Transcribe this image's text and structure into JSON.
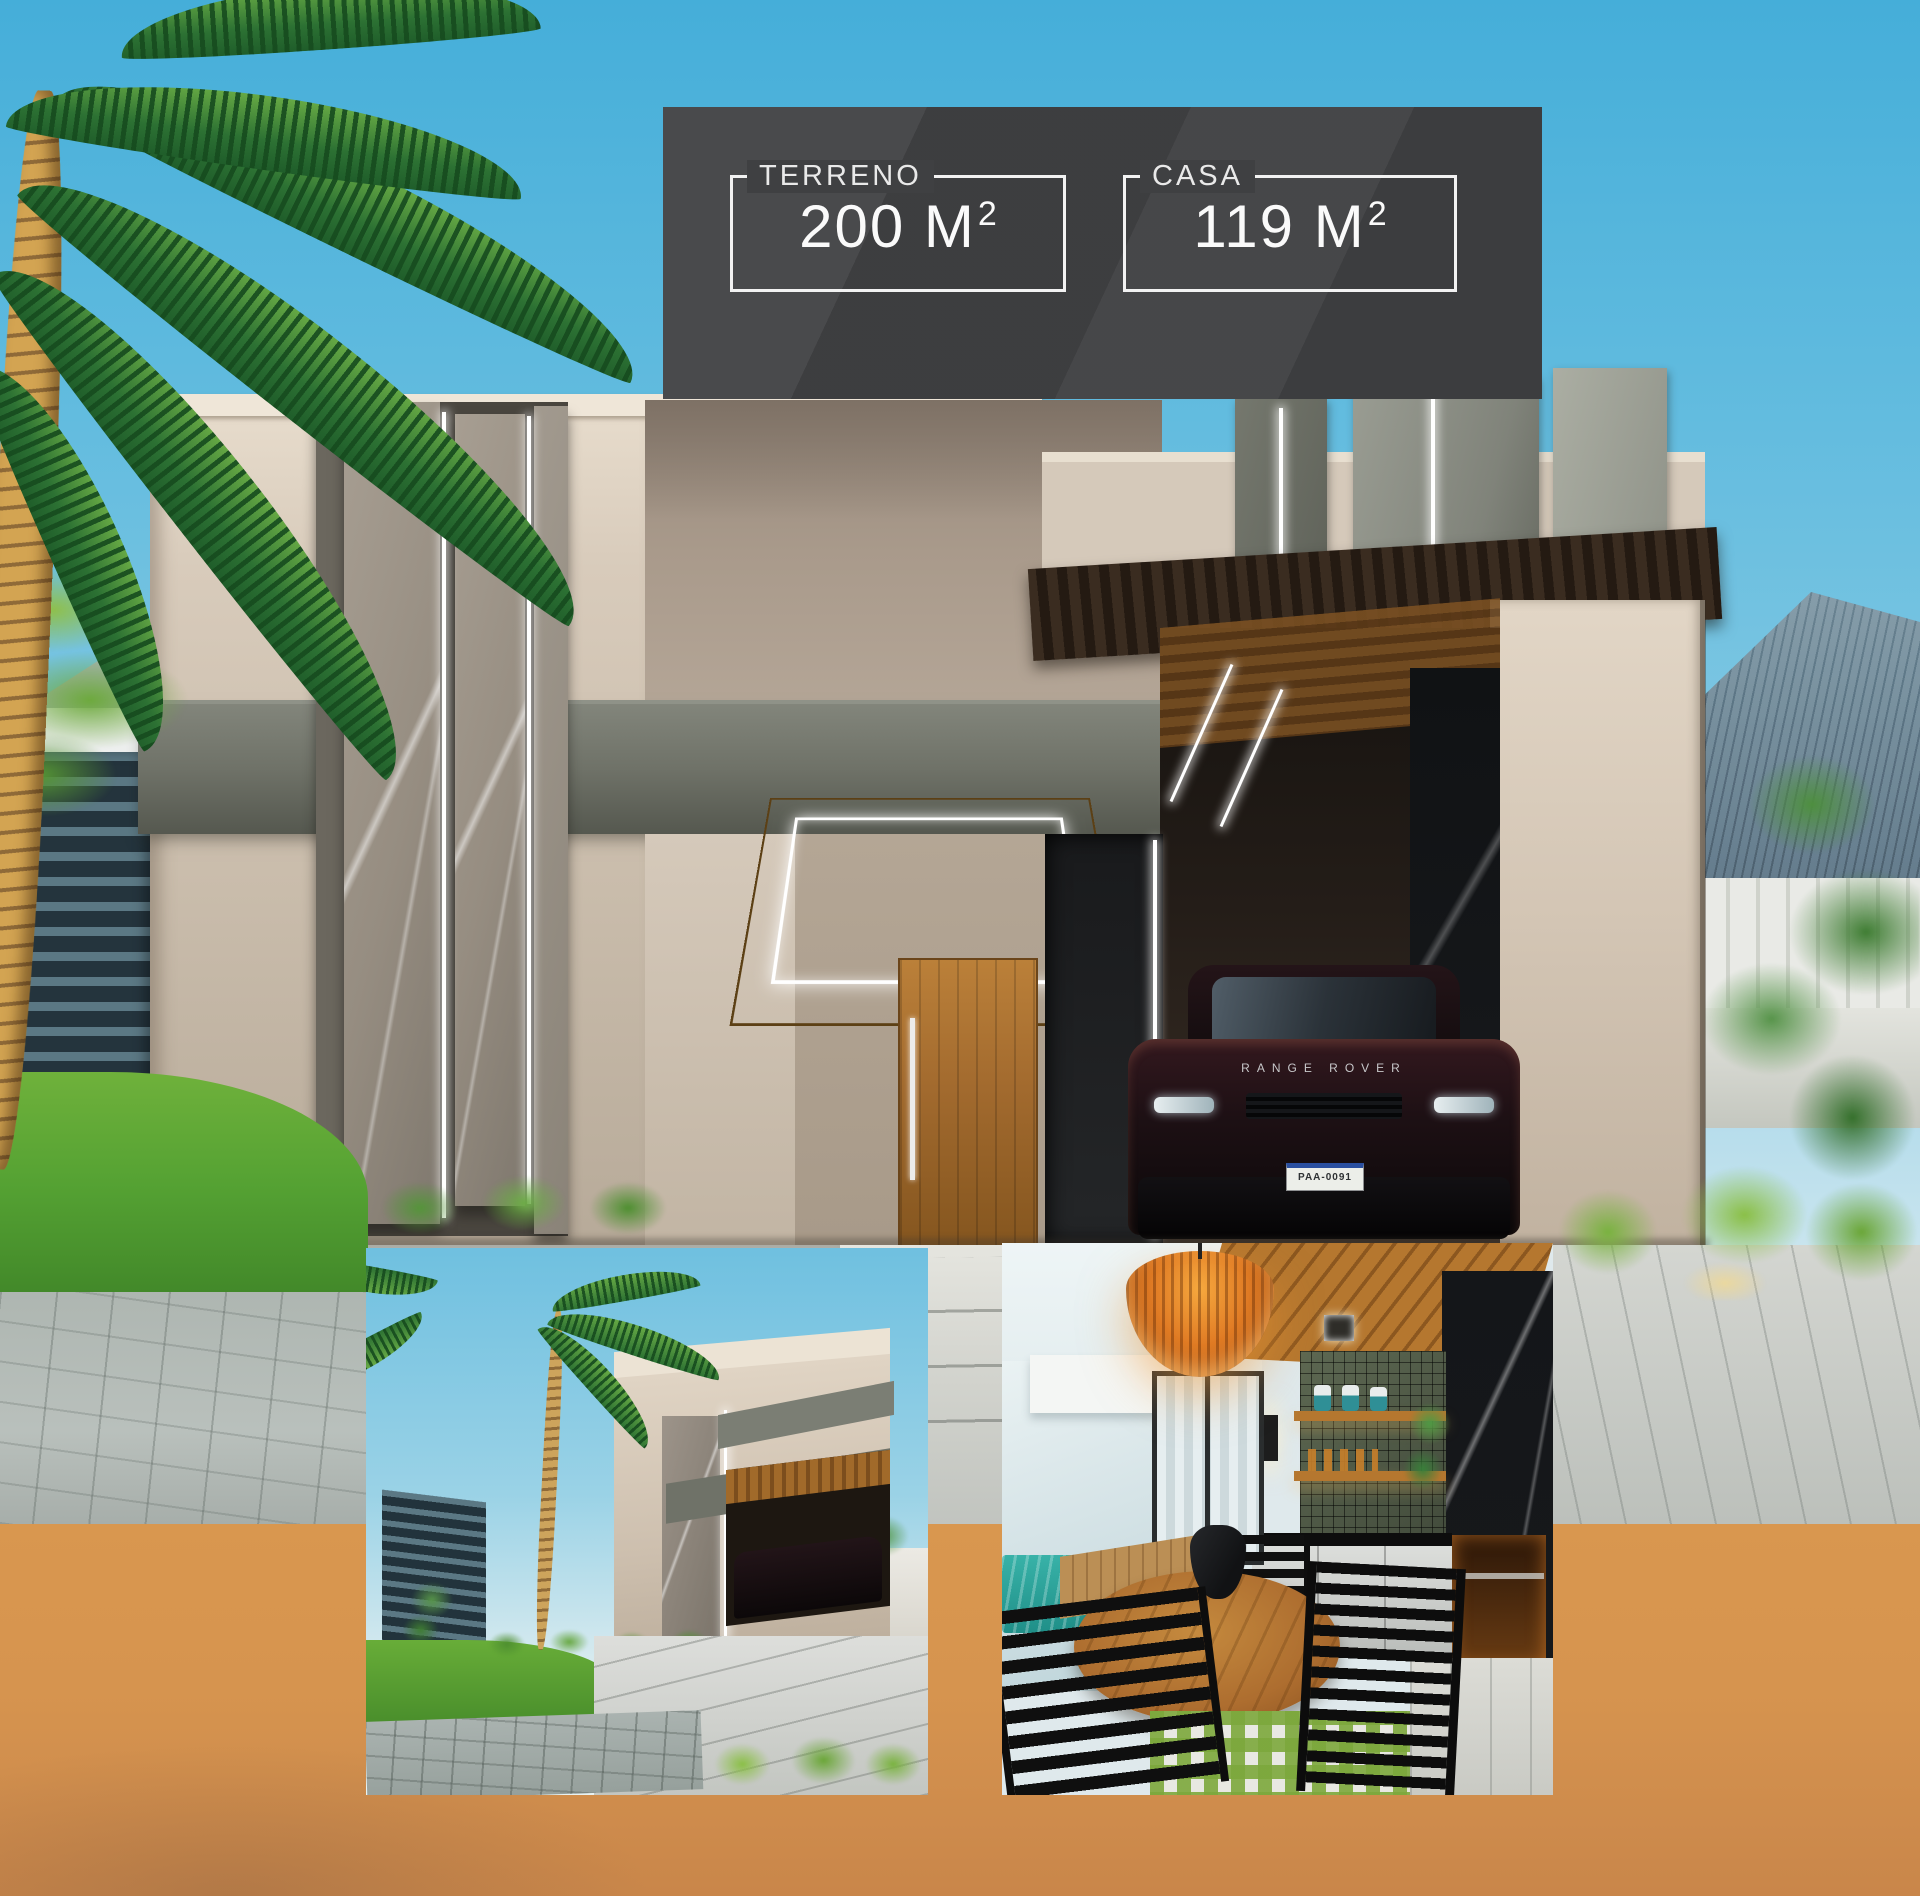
{
  "badge": {
    "background": "#3f4042",
    "border_color": "#f2f2f2",
    "specs": [
      {
        "id": "terreno",
        "label": "TERRENO",
        "value": "200 M",
        "sup": "2",
        "text": "200 M²"
      },
      {
        "id": "casa",
        "label": "CASA",
        "value": "119 M",
        "sup": "2",
        "text": "119 M²"
      }
    ]
  },
  "car": {
    "brand_text": "RANGE ROVER",
    "plate_text": "PAA-0091"
  },
  "colors": {
    "sky_top": "#45aed9",
    "sky_mid": "#7cc6e2",
    "sky_horizon": "#d7ebf1",
    "badge_bg": "#3f4042",
    "badge_text": "#f2f2f2",
    "orange": "#d6944f",
    "orange_deep": "#c9864a",
    "wall_light": "#dcd0c1",
    "wall_mid": "#c9bcab",
    "wall_shadow": "#a89a8c",
    "beam_gray": "#6f7268",
    "slab_gray": "#968d81",
    "led_white": "#ffffff",
    "wood": "#a96f2c",
    "door_wood": "#a26a2e",
    "grass": "#55a233",
    "grass_dark": "#387b24",
    "fence_dark": "#24343d",
    "fence_light": "#5b7884",
    "pave_light": "#d8d9d3",
    "pave_mid": "#b9c0bc",
    "pool": "#2aa39b",
    "pendant": "#e07b24",
    "marble_black": "#17191c",
    "car_dark": "#150f11"
  }
}
